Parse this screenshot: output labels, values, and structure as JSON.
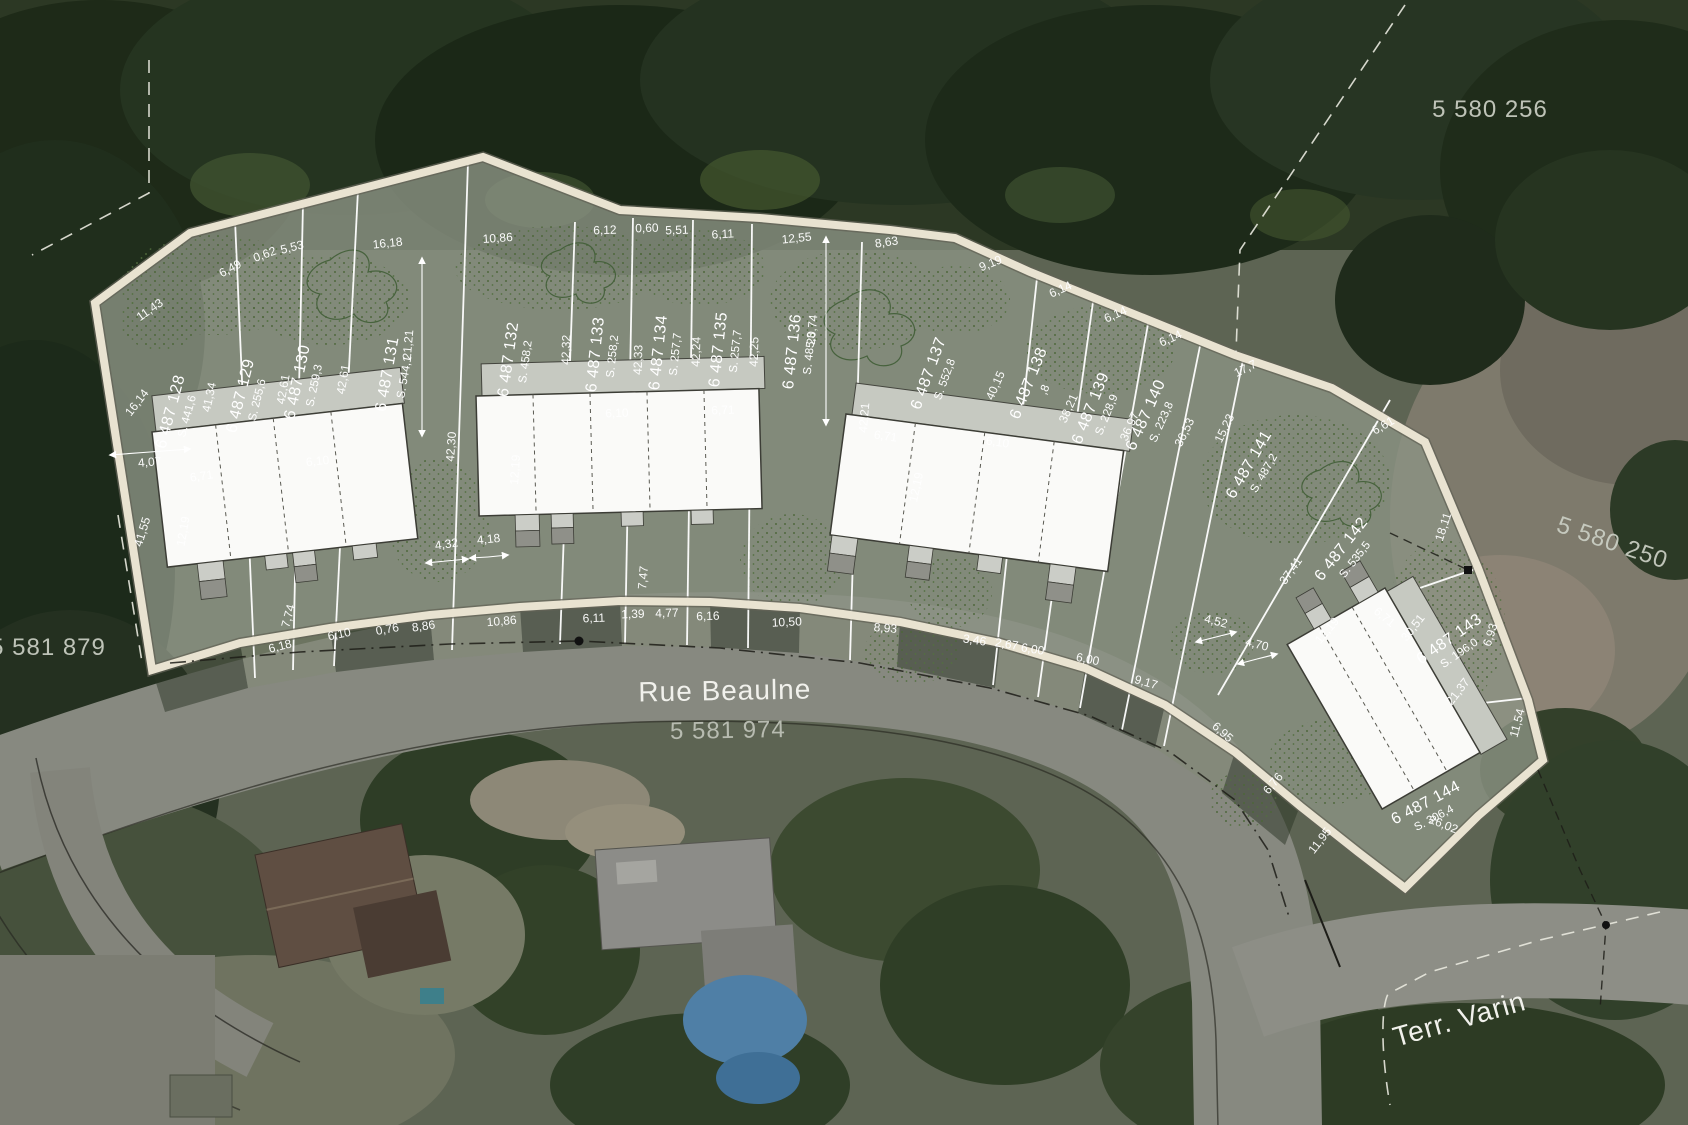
{
  "labels": {
    "street_name": "Rue Beaulne",
    "street_parcel_number": "5 581 974",
    "side_street_name": "Terr. Varin",
    "neighbor_parcel_top": "5 580 256",
    "neighbor_parcel_right": "5 580 250",
    "neighbor_parcel_left": "5 581 879"
  },
  "lots": [
    {
      "id": "6 487 128",
      "area": "S. 441,6"
    },
    {
      "id": "6 487 129",
      "area": "S. 255,6"
    },
    {
      "id": "6 487 130",
      "area": "S. 259,3"
    },
    {
      "id": "6 487 131",
      "area": "S. 544,1"
    },
    {
      "id": "6 487 132",
      "area": "S. 458,2"
    },
    {
      "id": "6 487 133",
      "area": "S. 258,2"
    },
    {
      "id": "6 487 134",
      "area": "S. 257,7"
    },
    {
      "id": "6 487 135",
      "area": "S. 257,7"
    },
    {
      "id": "6 487 136",
      "area": "S. 485,3"
    },
    {
      "id": "6 487 137",
      "area": "S. 552,8"
    },
    {
      "id": "6 487 138",
      "area": ",8"
    },
    {
      "id": "6 487 139",
      "area": "S. 228,9"
    },
    {
      "id": "6 487 140",
      "area": "S. 223,8"
    },
    {
      "id": "6 487 141",
      "area": "S. 487,2"
    },
    {
      "id": "6 487 142",
      "area": "S. 535,5"
    },
    {
      "id": "6 487 143",
      "area": "S. 196,0"
    },
    {
      "id": "6 487 144",
      "area": "S. 306,4"
    }
  ],
  "dims": {
    "top_edge": [
      "11,43",
      "6,49",
      "0,62",
      "5,53",
      "16,18",
      "10,86",
      "6,12",
      "0,60",
      "5,51",
      "6,11",
      "12,55",
      "8,63",
      "9,19",
      "6,14",
      "6,14",
      "6,14",
      "17,7",
      "6,61"
    ],
    "right_edge": [
      "18,11",
      "6,93",
      "11,54"
    ],
    "lot_lines": [
      "16,14",
      "41,55",
      "41,34",
      "42,61",
      "42,61",
      "21,21",
      "42,30",
      "42,32",
      "42,33",
      "42,24",
      "42,25",
      "20,74",
      "42,21",
      "40,15",
      "38,21",
      "36,97",
      "36,53",
      "15,23",
      "37,41",
      "30,51",
      "21,37"
    ],
    "street_edge": [
      "4,07",
      "6,18",
      "7,74",
      "6,10",
      "0,76",
      "8,86",
      "10,86",
      "4,32",
      "4,18",
      "6,11",
      "1,39",
      "4,77",
      "6,16",
      "10,50",
      "8,93",
      "3,46",
      "2,67",
      "6,00",
      "6,00",
      "9,17",
      "4,52",
      "4,70",
      "6,95",
      "11,95",
      "6,76",
      "26,02"
    ],
    "buildings": [
      "6,71",
      "6,10",
      "12,19",
      "12,19",
      "6,10",
      "6,71",
      "7,47",
      "6,71",
      "12,19",
      "6,10",
      "12,19",
      "6,71"
    ]
  }
}
